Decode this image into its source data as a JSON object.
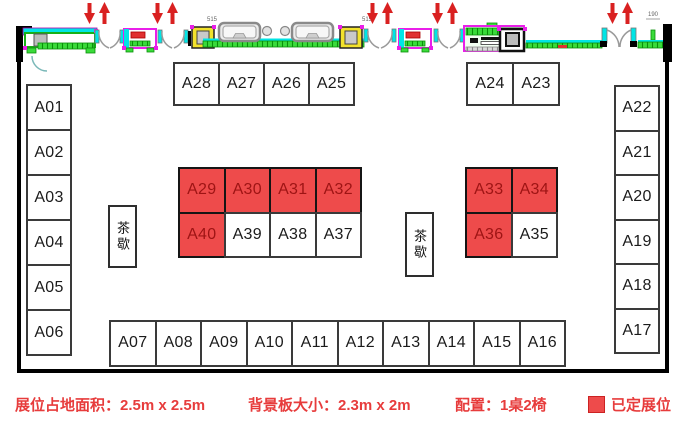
{
  "legend": {
    "booth_area": "展位占地面积：2.5m x 2.5m",
    "backdrop_size": "背景板大小：2.3m x 2m",
    "configuration": "配置：1桌2椅",
    "booked_label": "已定展位"
  },
  "tea_breaks": [
    {
      "label": "茶歇"
    },
    {
      "label": "茶歇"
    }
  ],
  "annotations": {
    "column_left": "515",
    "column_right": "515",
    "door_dim": "190"
  },
  "colors": {
    "booked_fill": "#EE4B4B",
    "booked_text": "#9E1414",
    "legend_text": "#E73C3C",
    "arrow_red": "#D92121"
  },
  "booth_groups": [
    {
      "name": "left-column",
      "booths": [
        {
          "id": "A01",
          "booked": false
        },
        {
          "id": "A02",
          "booked": false
        },
        {
          "id": "A03",
          "booked": false
        },
        {
          "id": "A04",
          "booked": false
        },
        {
          "id": "A05",
          "booked": false
        },
        {
          "id": "A06",
          "booked": false
        }
      ]
    },
    {
      "name": "top-middle-row",
      "booths": [
        {
          "id": "A28",
          "booked": false
        },
        {
          "id": "A27",
          "booked": false
        },
        {
          "id": "A26",
          "booked": false
        },
        {
          "id": "A25",
          "booked": false
        }
      ]
    },
    {
      "name": "top-right-row",
      "booths": [
        {
          "id": "A24",
          "booked": false
        },
        {
          "id": "A23",
          "booked": false
        }
      ]
    },
    {
      "name": "center-row-1",
      "booths": [
        {
          "id": "A29",
          "booked": true
        },
        {
          "id": "A30",
          "booked": true
        },
        {
          "id": "A31",
          "booked": true
        },
        {
          "id": "A32",
          "booked": true
        }
      ]
    },
    {
      "name": "center-row-2",
      "booths": [
        {
          "id": "A40",
          "booked": true
        },
        {
          "id": "A39",
          "booked": false
        },
        {
          "id": "A38",
          "booked": false
        },
        {
          "id": "A37",
          "booked": false
        }
      ]
    },
    {
      "name": "right-row-1",
      "booths": [
        {
          "id": "A33",
          "booked": true
        },
        {
          "id": "A34",
          "booked": true
        }
      ]
    },
    {
      "name": "right-row-2",
      "booths": [
        {
          "id": "A36",
          "booked": true
        },
        {
          "id": "A35",
          "booked": false
        }
      ]
    },
    {
      "name": "bottom-row",
      "booths": [
        {
          "id": "A07",
          "booked": false
        },
        {
          "id": "A08",
          "booked": false
        },
        {
          "id": "A09",
          "booked": false
        },
        {
          "id": "A10",
          "booked": false
        },
        {
          "id": "A11",
          "booked": false
        },
        {
          "id": "A12",
          "booked": false
        },
        {
          "id": "A13",
          "booked": false
        },
        {
          "id": "A14",
          "booked": false
        },
        {
          "id": "A15",
          "booked": false
        },
        {
          "id": "A16",
          "booked": false
        }
      ]
    },
    {
      "name": "right-column",
      "booths": [
        {
          "id": "A22",
          "booked": false
        },
        {
          "id": "A21",
          "booked": false
        },
        {
          "id": "A20",
          "booked": false
        },
        {
          "id": "A19",
          "booked": false
        },
        {
          "id": "A18",
          "booked": false
        },
        {
          "id": "A17",
          "booked": false
        }
      ]
    }
  ]
}
